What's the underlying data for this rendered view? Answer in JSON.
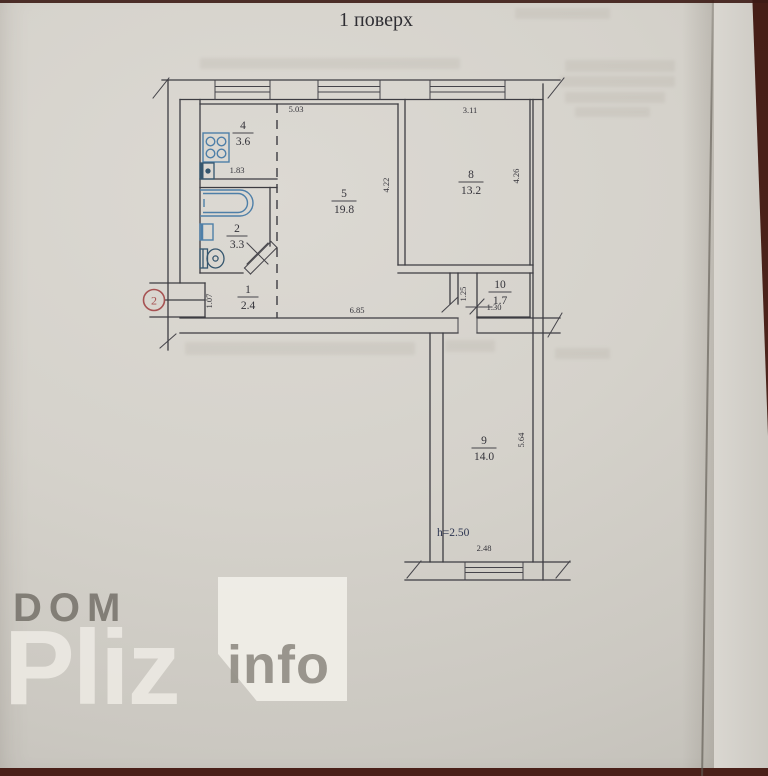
{
  "title": "1 поверх",
  "plan": {
    "rooms": {
      "r4": {
        "num": "4",
        "area": "3.6"
      },
      "r2": {
        "num": "2",
        "area": "3.3"
      },
      "r1": {
        "num": "1",
        "area": "2.4"
      },
      "r5": {
        "num": "5",
        "area": "19.8"
      },
      "r8": {
        "num": "8",
        "area": "13.2"
      },
      "r10": {
        "num": "10",
        "area": "1.7"
      },
      "r9": {
        "num": "9",
        "area": "14.0"
      }
    },
    "dims": {
      "top_span": "5.03",
      "kitchen_width": "1.83",
      "room8_width": "3.11",
      "room5_depth": "4.22",
      "room8_depth": "4.26",
      "room5_width": "6.85",
      "entry_width": "1.07",
      "corridor_width": "1.25",
      "room10_width": "1.30",
      "room9_depth": "5.64",
      "room9_width": "2.48",
      "ceiling_height": "h=2.50"
    },
    "marker_label": "2",
    "fixtures": [
      "stove",
      "kitchen-sink",
      "bathtub",
      "washbasin",
      "toilet"
    ]
  },
  "watermark": {
    "word1": "DOM",
    "word2": "Pliz",
    "word3": "info"
  },
  "colors": {
    "paper": "#d5d2cb",
    "table": "#4a2019",
    "ink": "#3d3c42",
    "fixture_blue": "#4e7fa8",
    "marker_red": "#a65252",
    "height_note": "#2c3550"
  }
}
